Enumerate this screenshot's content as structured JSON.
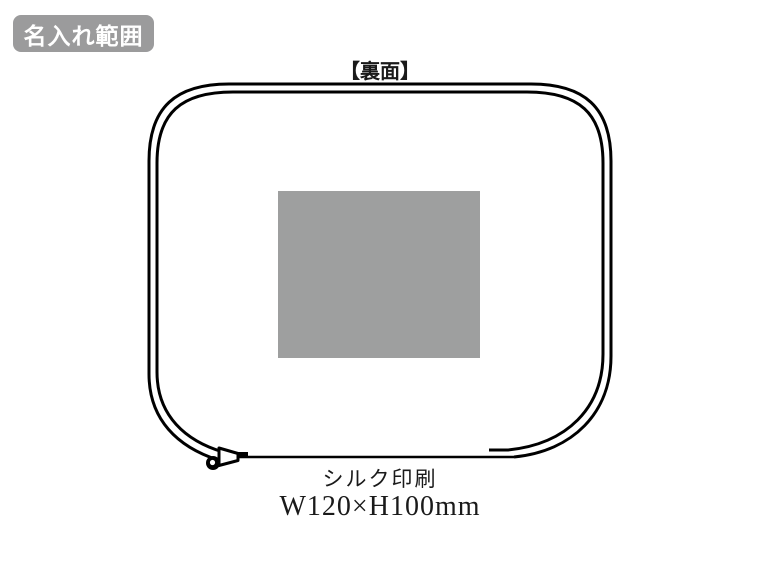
{
  "badge": {
    "label": "名入れ範囲",
    "bg_color": "#9b9b9c",
    "text_color": "#ffffff"
  },
  "diagram": {
    "side_label": "【裏面】",
    "outline_color": "#000000",
    "print_area_color": "#9e9f9f",
    "caption": {
      "method": "シルク印刷",
      "size": "W120×H100mm"
    }
  }
}
